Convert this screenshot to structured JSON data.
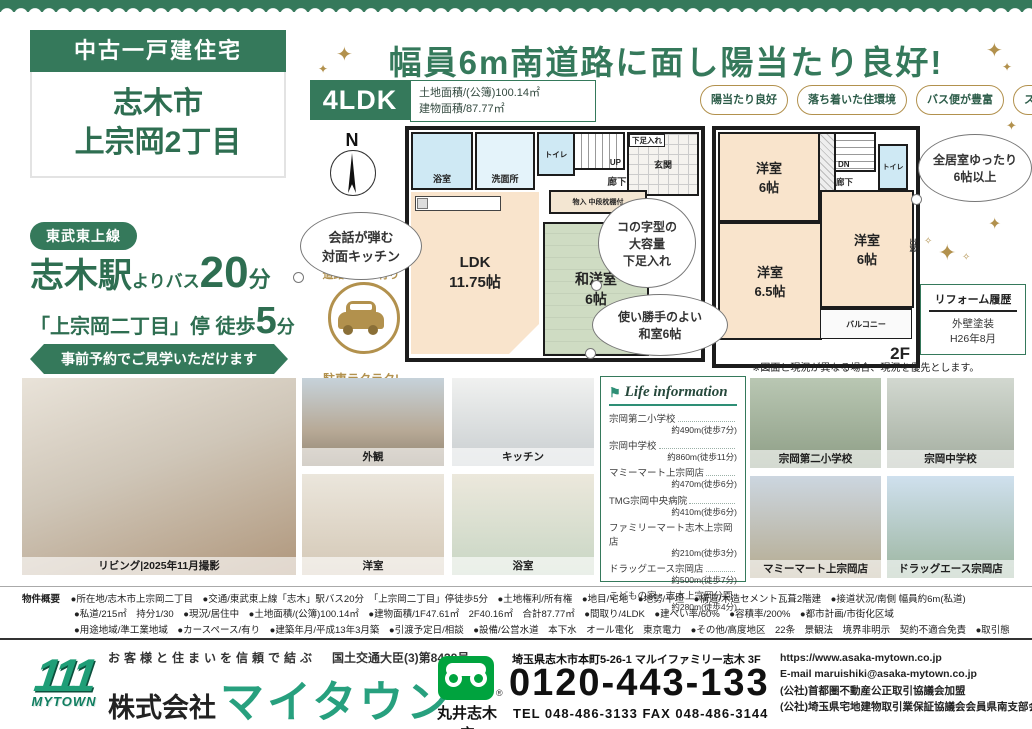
{
  "colors": {
    "green": "#35795b",
    "gold": "#b2914d",
    "freedial_green": "#00a33e",
    "logo_green": "#1f9e77"
  },
  "icons": {
    "flag": "⚑",
    "sparkle": "✦",
    "sparkle_small": "✧",
    "plus": "+",
    "reg": "®"
  },
  "title_card": {
    "category": "中古一戸建住宅",
    "city": "志木市",
    "district": "上宗岡2丁目"
  },
  "headline": {
    "text": "幅員6m南道路に面し陽当たり良好!"
  },
  "plan_summary": {
    "layout": "4LDK",
    "land": "土地面積/(公簿)100.14㎡",
    "building": "建物面積/87.77㎡"
  },
  "badges": [
    "陽当たり良好",
    "落ち着いた住環境",
    "バス便が豊富",
    "スーパー至近で便利"
  ],
  "access": {
    "line": "東武東上線",
    "station": "志木駅",
    "via": "よりバス",
    "bus_min": "20",
    "bus_unit": "分",
    "stop": "「上宗岡二丁目」停 徒歩",
    "walk_min": "5",
    "walk_unit": "分",
    "banner": "事前予約でご見学いただけます"
  },
  "floorplan": {
    "compass": "N",
    "bubble_kitchen": "会話が弾む\n対面キッチン",
    "bubble_shoes": "コの字型の\n大容量\n下足入れ",
    "bubble_washitsu": "使い勝手のよい\n和室6帖",
    "bubble_rooms": "全居室ゆったり\n6帖以上",
    "car_top": "道路ゆとり有り",
    "car_bottom": "駐車ラクラク!",
    "f1_label": "1F",
    "f2_label": "2F",
    "f1": {
      "bath": "浴室",
      "wash": "洗面所",
      "toilet": "トイレ",
      "stairs": "UP",
      "shoes": "下足入れ",
      "entrance": "玄関",
      "hall": "廊下",
      "storage": "物入 中段枕棚付",
      "ldk": "LDK\n11.75帖",
      "wayo": "和洋室\n6帖"
    },
    "f2": {
      "stairs": "DN",
      "toilet": "トイレ",
      "hall": "廊下",
      "room_a": "洋室\n6帖",
      "room_b": "洋室\n6帖",
      "room_c": "洋室\n6.5帖",
      "balcony": "バルコニー",
      "baywindow": "出窓"
    },
    "reform": {
      "title": "リフォーム履歴",
      "work": "外壁塗装",
      "date": "H26年8月"
    },
    "note": "※図面と現況が異なる場合、現況を優先とします。"
  },
  "life_info": {
    "title": "Life information",
    "items": [
      {
        "name": "宗岡第二小学校",
        "dist": "約490m(徒歩7分)"
      },
      {
        "name": "宗岡中学校",
        "dist": "約860m(徒歩11分)"
      },
      {
        "name": "マミーマート上宗岡店",
        "dist": "約470m(徒歩6分)"
      },
      {
        "name": "TMG宗岡中央病院",
        "dist": "約410m(徒歩6分)"
      },
      {
        "name": "ファミリーマート志木上宗岡店",
        "dist": "約210m(徒歩3分)"
      },
      {
        "name": "ドラッグエース宗岡店",
        "dist": "約500m(徒歩7分)"
      },
      {
        "name": "こどもの家・志木上宗岡分園",
        "dist": "約280m(徒歩4分)"
      }
    ]
  },
  "photos": {
    "living": "リビング|2025年11月撮影",
    "exterior": "外観",
    "kitchen": "キッチン",
    "bedroom": "洋室",
    "bathroom": "浴室",
    "school1": "宗岡第二小学校",
    "school2": "宗岡中学校",
    "store1": "マミーマート上宗岡店",
    "store2": "ドラッグエース宗岡店"
  },
  "outline": {
    "label": "物件概要",
    "line1": "●所在地/志木市上宗岡二丁目　●交通/東武東上線「志木」駅バス20分　「上宗岡二丁目」停徒歩5分　●土地権利/所有権　●地目/宅地　●地勢/平坦　●構造/木造セメント瓦葺2階建　●接道状況/南側 幅員約6m(私道)",
    "line2": "●私道/215㎡　持分1/30　●現況/居住中　●土地面積/(公簿)100.14㎡　●建物面積/1F47.61㎡　2F40.16㎡　合計87.77㎡　●間取り/4LDK　●建ぺい率/60%　●容積率/200%　●都市計画/市街化区域",
    "line3": "●用途地域/準工業地域　●カースペース/有り　●建築年月/平成13年3月築　●引渡予定日/相談　●設備/公営水道　本下水　オール電化　東京電力　●その他/高度地区　22条　景観法　境界非明示　契約不適合免責　●取引態様/専任媒介"
  },
  "footer": {
    "tagline": "お客様と住まいを信頼で結ぶ",
    "license": "国土交通大臣(3)第8439号",
    "logo_numbers": "111",
    "logo_text": "MYTOWN",
    "company_prefix": "株式会社",
    "company_name": "マイタウン",
    "branch": "丸井志木店",
    "address": "埼玉県志木市本町5-26-1 マルイファミリー志木 3F",
    "freedial": "0120-443-133",
    "telfax": "TEL 048-486-3133 FAX 048-486-3144",
    "url": "https://www.asaka-mytown.co.jp",
    "email": "E-mail maruishiki@asaka-mytown.co.jp",
    "assoc1": "(公社)首都圏不動産公正取引協議会加盟",
    "assoc2": "(公社)埼玉県宅地建物取引業保証協議会会員県南支部会員"
  }
}
